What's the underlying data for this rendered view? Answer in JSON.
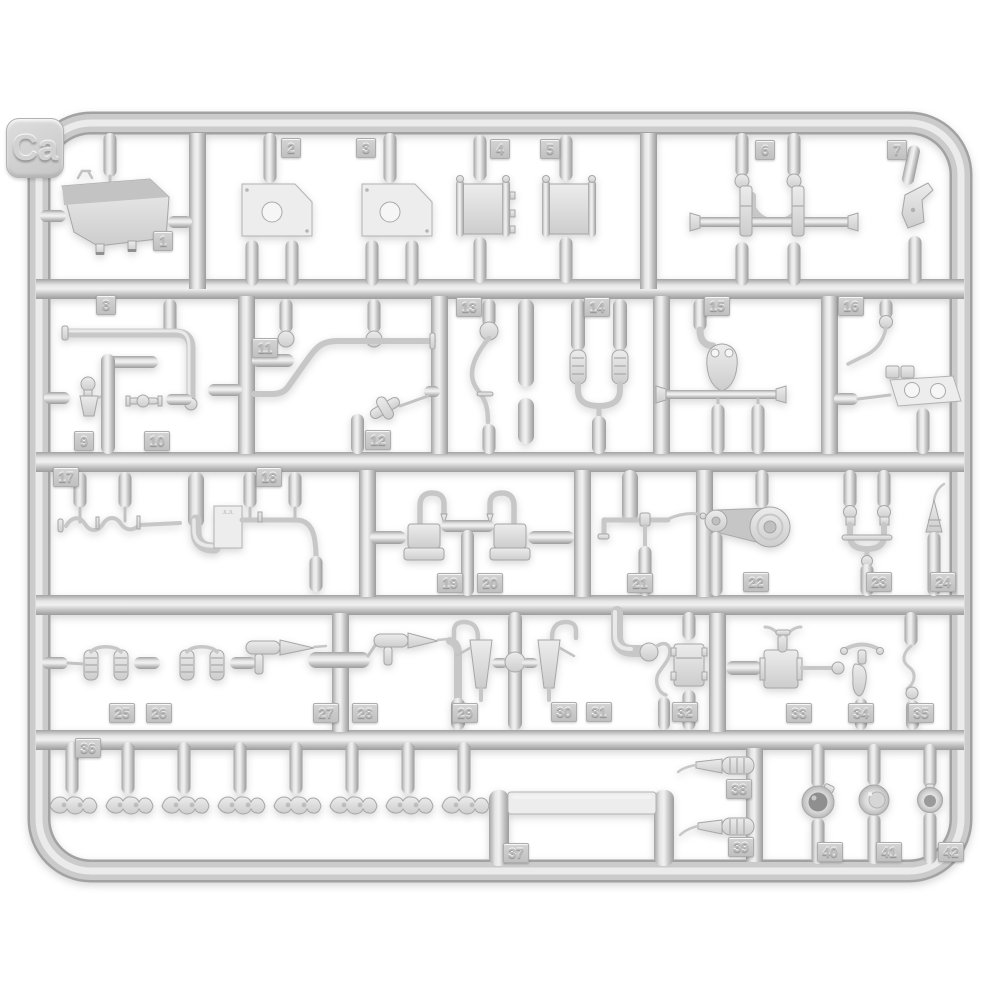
{
  "subject": "light grey injection-molded plastic model kit sprue photographed on white",
  "sprue": {
    "label": "Ca",
    "part_count": 42,
    "part_numbers": [
      "1",
      "2",
      "3",
      "4",
      "5",
      "6",
      "7",
      "8",
      "9",
      "10",
      "11",
      "12",
      "13",
      "14",
      "15",
      "16",
      "17",
      "18",
      "19",
      "20",
      "21",
      "22",
      "23",
      "24",
      "25",
      "26",
      "27",
      "28",
      "29",
      "30",
      "31",
      "32",
      "33",
      "34",
      "35",
      "36",
      "37",
      "38",
      "39",
      "40",
      "41",
      "42"
    ],
    "plate_marking": "JLJL",
    "identical_links_under_number_36": 8,
    "colors": {
      "background": "#ffffff",
      "plastic": "#cccccc",
      "plastic_highlight": "#efefef",
      "plastic_shadow": "#9f9f9f",
      "part_fill": "#e3e3e3",
      "horn_center_dark": "#8f8f8f"
    }
  }
}
